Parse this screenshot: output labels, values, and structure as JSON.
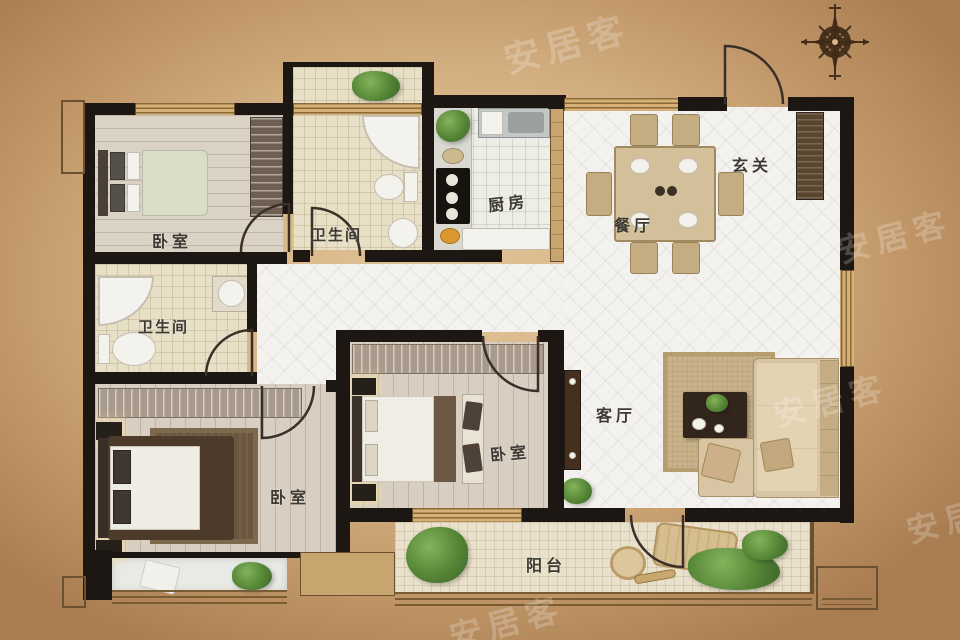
{
  "watermark": {
    "text": "安居客",
    "color": "#ffffff",
    "opacity": 0.22
  },
  "labels": {
    "bedroom_top_left": "卧室",
    "bathroom_top": "卫生间",
    "kitchen": "厨房",
    "dining": "餐厅",
    "foyer": "玄关",
    "bathroom_left": "卫生间",
    "bedroom_middle": "卧室",
    "bedroom_bottom_left": "卧室",
    "living": "客厅",
    "balcony": "阳台"
  },
  "icons": {
    "compass": "compass-rose-icon"
  },
  "colors": {
    "wall": "#1c1712",
    "background_center": "#e0c296",
    "background_edge": "#a97d51",
    "label_text": "#3d3a33",
    "window_frame": "#c8a46f",
    "diamond_tile": "#f4f2ee"
  }
}
